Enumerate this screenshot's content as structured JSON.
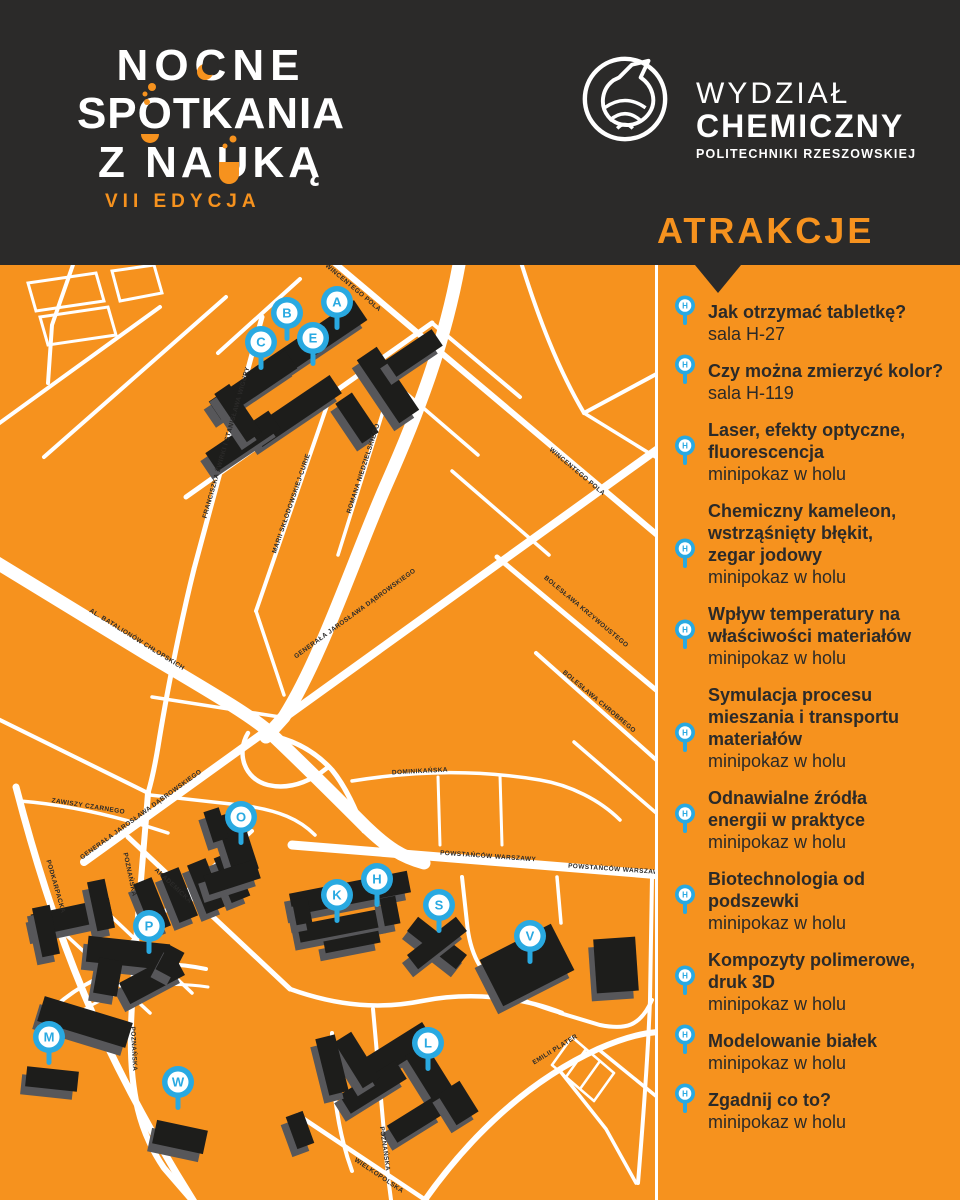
{
  "header": {
    "title_lines": [
      "NOCNE",
      "SPOTKANIA",
      "Z NAUKĄ"
    ],
    "edition": "VII EDYCJA",
    "faculty": {
      "line1": "WYDZIAŁ",
      "line2": "CHEMICZNY",
      "line3": "POLITECHNIKI RZESZOWSKIEJ"
    },
    "attractions_heading": "ATRAKCJE"
  },
  "colors": {
    "orange": "#f6921e",
    "dark": "#2b2a29",
    "blue": "#29a9e1",
    "white": "#ffffff",
    "building": "#1d1d1b",
    "building_side": "#57575a"
  },
  "map": {
    "markers": [
      {
        "letter": "A",
        "x": 337,
        "y": 37
      },
      {
        "letter": "B",
        "x": 287,
        "y": 48
      },
      {
        "letter": "C",
        "x": 261,
        "y": 77
      },
      {
        "letter": "E",
        "x": 313,
        "y": 73
      },
      {
        "letter": "O",
        "x": 241,
        "y": 552
      },
      {
        "letter": "K",
        "x": 337,
        "y": 630
      },
      {
        "letter": "H",
        "x": 377,
        "y": 614
      },
      {
        "letter": "S",
        "x": 439,
        "y": 640
      },
      {
        "letter": "V",
        "x": 530,
        "y": 671
      },
      {
        "letter": "P",
        "x": 149,
        "y": 661
      },
      {
        "letter": "M",
        "x": 49,
        "y": 772
      },
      {
        "letter": "W",
        "x": 178,
        "y": 817
      },
      {
        "letter": "L",
        "x": 428,
        "y": 778
      }
    ],
    "street_labels": [
      {
        "text": "WINCENTEGO POLA",
        "x": 352,
        "y": 24,
        "rot": 40
      },
      {
        "text": "WINCENTEGO POLA",
        "x": 576,
        "y": 208,
        "rot": 40
      },
      {
        "text": "FRANCISZKA ŻWIRKI I STANISŁAWA WIGURY",
        "x": 228,
        "y": 178,
        "rot": -74
      },
      {
        "text": "MARII SKŁODOWSKIEJ-CURIE",
        "x": 293,
        "y": 239,
        "rot": -71
      },
      {
        "text": "ROMANA NIEDZIELSKIEGO",
        "x": 365,
        "y": 204,
        "rot": -72
      },
      {
        "text": "GENERAŁA JAROSŁAWA DĄBROWSKIEGO",
        "x": 356,
        "y": 350,
        "rot": -36
      },
      {
        "text": "GENERAŁA JAROSŁAWA DĄBROWSKIEGO",
        "x": 142,
        "y": 551,
        "rot": -36
      },
      {
        "text": "ZAWISZY CZARNEGO",
        "x": 88,
        "y": 543,
        "rot": 9
      },
      {
        "text": "AL. BATALIONÓW CHŁOPSKICH",
        "x": 136,
        "y": 376,
        "rot": 32
      },
      {
        "text": "PODKARPACKA",
        "x": 54,
        "y": 622,
        "rot": 74
      },
      {
        "text": "POZNAŃSKA",
        "x": 128,
        "y": 610,
        "rot": 78
      },
      {
        "text": "POZNAŃSKA",
        "x": 132,
        "y": 784,
        "rot": 87
      },
      {
        "text": "AKADEMICKA",
        "x": 172,
        "y": 622,
        "rot": 43
      },
      {
        "text": "POWSTAŃCÓW WARSZAWY",
        "x": 488,
        "y": 593,
        "rot": 4
      },
      {
        "text": "POWSTAŃCÓW WARSZAWY",
        "x": 616,
        "y": 606,
        "rot": 4
      },
      {
        "text": "DOMINIKAŃSKA",
        "x": 420,
        "y": 508,
        "rot": -3
      },
      {
        "text": "EMILII PLATER",
        "x": 556,
        "y": 786,
        "rot": -32
      },
      {
        "text": "POZNAŃSKA",
        "x": 383,
        "y": 884,
        "rot": 82
      },
      {
        "text": "WIELKOPOLSKA",
        "x": 378,
        "y": 912,
        "rot": 34
      },
      {
        "text": "BOLESŁAWA KRZYWOUSTEGO",
        "x": 585,
        "y": 348,
        "rot": 40
      },
      {
        "text": "BOLESŁAWA CHROBREGO",
        "x": 598,
        "y": 438,
        "rot": 40
      }
    ]
  },
  "sidebar": {
    "pin_letter": "H",
    "items": [
      {
        "title": "Jak otrzymać tabletkę?",
        "location": "sala H-27"
      },
      {
        "title": "Czy można zmierzyć kolor?",
        "location": "sala H-119"
      },
      {
        "title": "Laser, efekty optyczne,\nfluorescencja",
        "location": "minipokaz w holu"
      },
      {
        "title": "Chemiczny kameleon,\nwstrząśnięty błękit,\nzegar jodowy",
        "location": "minipokaz w holu"
      },
      {
        "title": "Wpływ temperatury na\nwłaściwości materiałów",
        "location": "minipokaz w holu"
      },
      {
        "title": "Symulacja procesu\nmieszania i transportu\nmateriałów",
        "location": "minipokaz w holu"
      },
      {
        "title": "Odnawialne źródła\nenergii w praktyce",
        "location": "minipokaz w holu"
      },
      {
        "title": "Biotechnologia od\npodszewki",
        "location": "minipokaz w holu"
      },
      {
        "title": "Kompozyty polimerowe,\ndruk 3D",
        "location": "minipokaz w holu"
      },
      {
        "title": "Modelowanie białek",
        "location": "minipokaz w holu"
      },
      {
        "title": "Zgadnij co to?",
        "location": "minipokaz w holu"
      }
    ]
  }
}
